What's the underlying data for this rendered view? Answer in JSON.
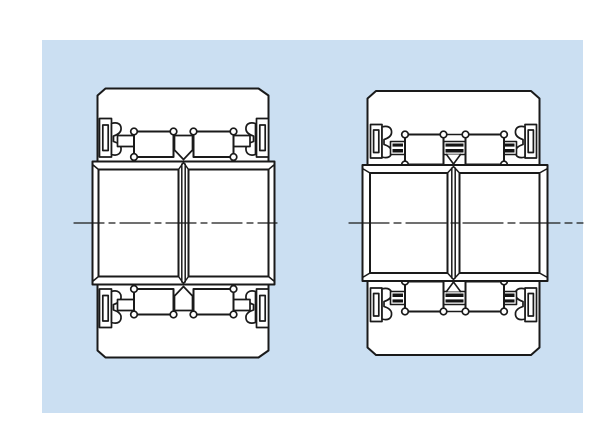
{
  "diagram": {
    "type": "technical-line-drawing",
    "figures": [
      {
        "name": "bearing-cross-section-left"
      },
      {
        "name": "bearing-cross-section-right"
      }
    ]
  },
  "colors": {
    "page_bg": "#ffffff",
    "panel_bg": "#cbdff2",
    "line": "#1a1a1a",
    "white_fill": "#ffffff",
    "pin_fill": "#141414"
  }
}
